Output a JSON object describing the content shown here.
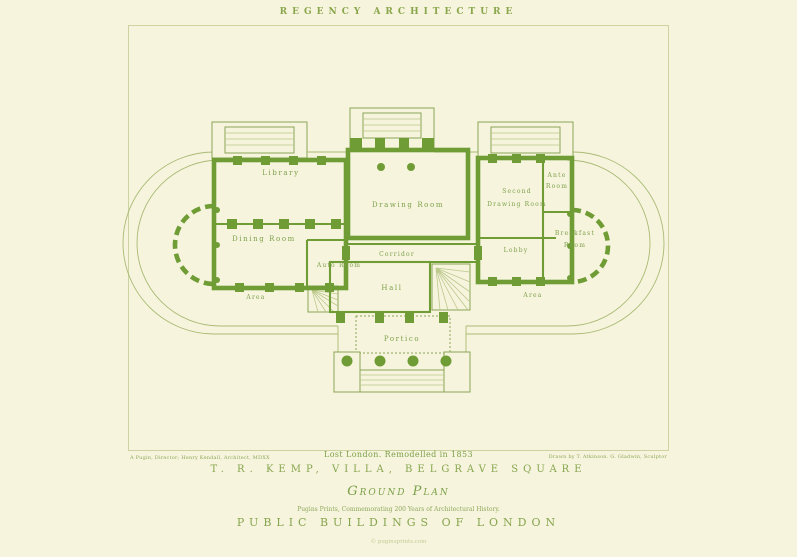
{
  "colors": {
    "paper": "#f6f4dd",
    "ink": "#6f9c35",
    "ink_light": "#8aa64c"
  },
  "header": {
    "title": "REGENCY ARCHITECTURE"
  },
  "plan": {
    "rooms": {
      "library": "Library",
      "dining_room": "Dining Room",
      "auto_room": "Auto Room",
      "corridor": "Corridor",
      "hall": "Hall",
      "drawing_room": "Drawing Room",
      "second_drawing_room_line1": "Second",
      "second_drawing_room_line2": "Drawing Room",
      "ante_room_line1": "Ante",
      "ante_room_line2": "Room",
      "breakfast_room_line1": "Breakfast",
      "breakfast_room_line2": "Room",
      "lobby": "Lobby",
      "area_left": "Area",
      "area_right": "Area",
      "portico": "Portico"
    }
  },
  "footer": {
    "credit_left": "A Pugin, Director; Henry Kendall, Architect, MDXX",
    "caption_center": "Lost London. Remodelled in 1853",
    "credit_right": "Drawn by T. Atkinson. G. Gladwin, Sculptor",
    "villa_title": "T. R. KEMP, VILLA, BELGRAVE SQUARE",
    "plan_label": "Ground Plan",
    "series_note": "Pugins Prints, Commemorating 200 Years of Architectural History.",
    "series_title": "PUBLIC BUILDINGS OF LONDON",
    "watermark": "© puginsprints.com"
  }
}
